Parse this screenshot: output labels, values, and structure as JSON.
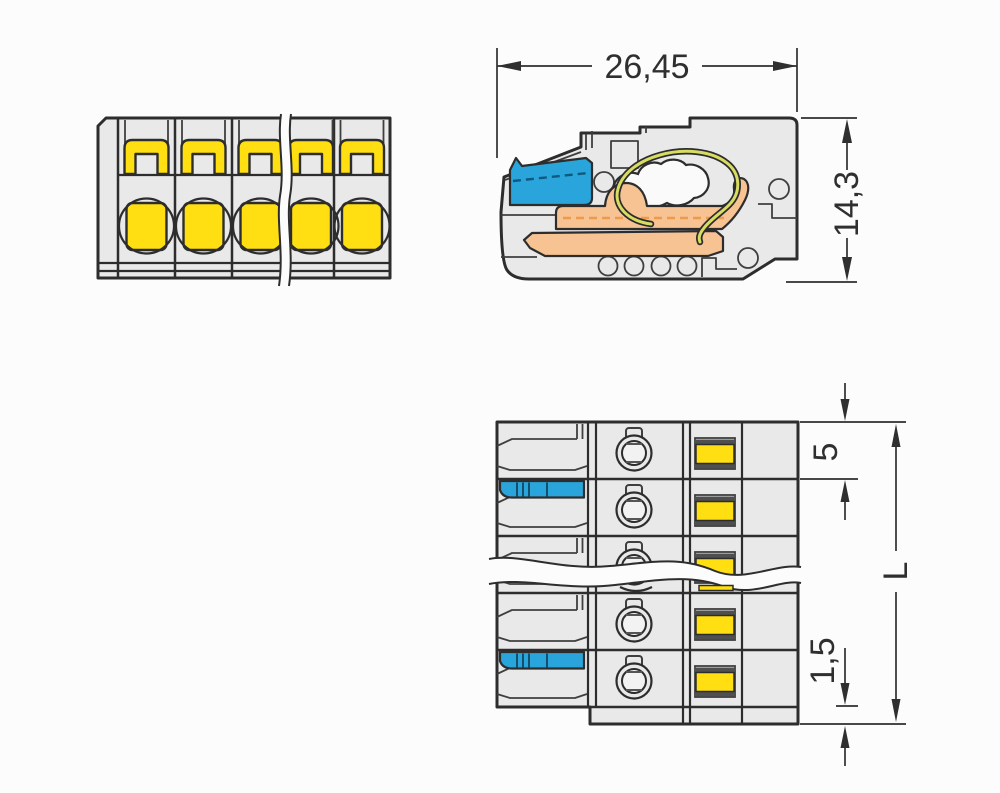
{
  "dimensions": {
    "overall_width": "26,45",
    "overall_height": "14,3",
    "pole_pitch": "5",
    "end_offset": "1,5",
    "total_length": "L"
  },
  "colors": {
    "background": "#fcfcfc",
    "housing_gray": "#e9e9e9",
    "outline": "#2d2d2d",
    "thin_line": "#3f3f3f",
    "dimension_line": "#2f2f2f",
    "clamp_yellow": "#ffdf12",
    "lever_blue": "#2aa5db",
    "busbar_orange": "#f8c393",
    "busbar_orange_dash": "#ee9a4d",
    "spring_yellow_green": "#d8dc62",
    "inner_light": "#f2f2f2"
  },
  "views": {
    "front": {
      "label": "front view, multi-pole female connector"
    },
    "side": {
      "label": "side cross-section view"
    },
    "top": {
      "label": "top view with pole pitch"
    }
  }
}
